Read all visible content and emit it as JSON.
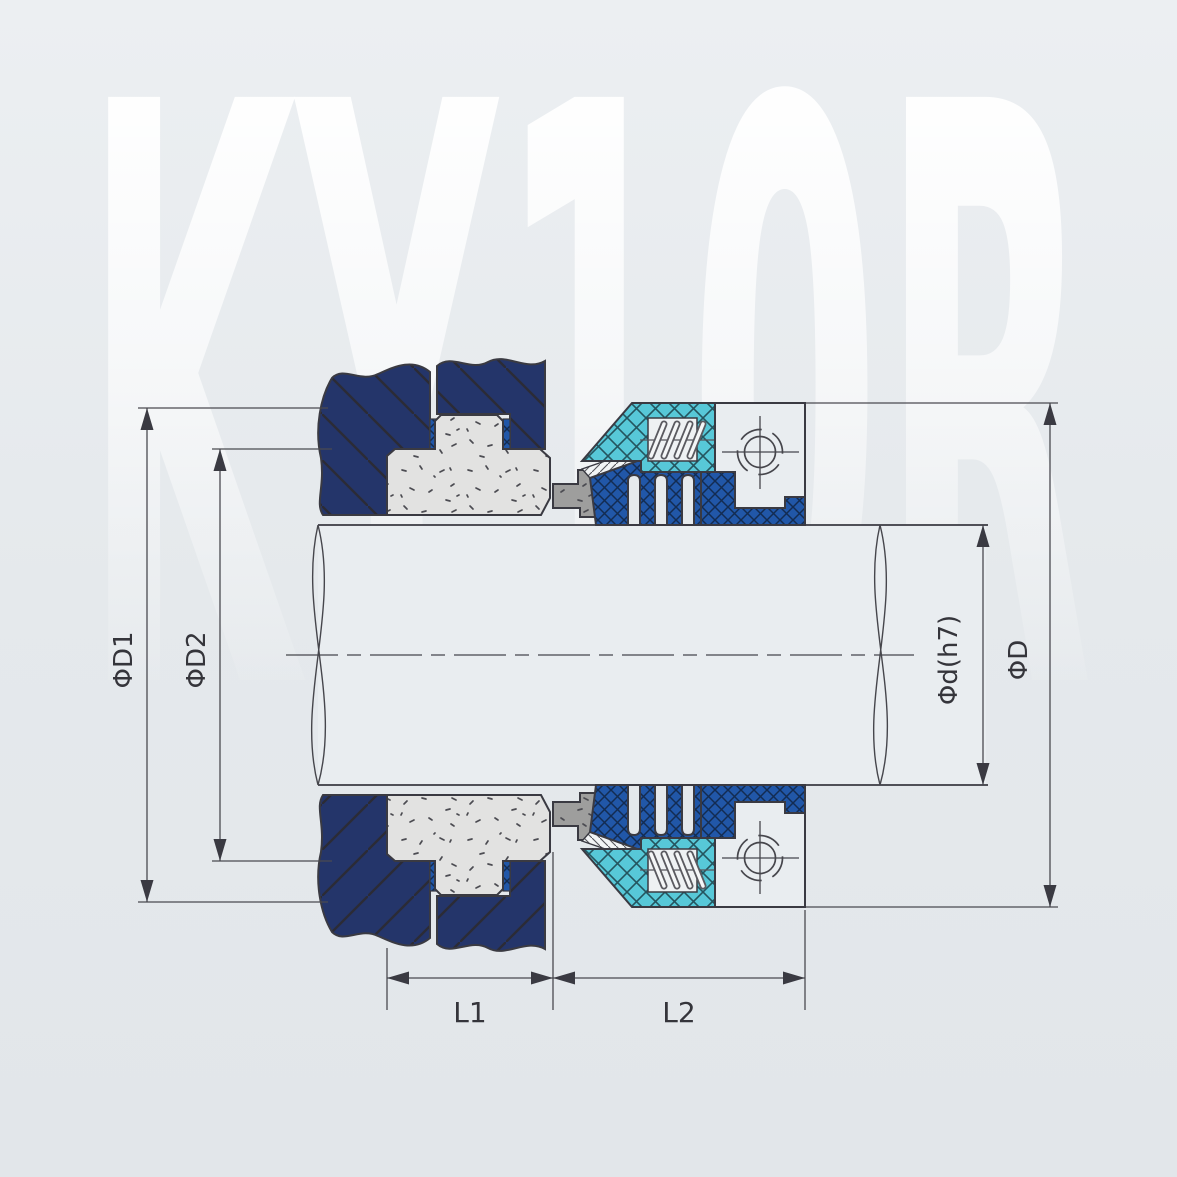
{
  "watermark": {
    "text": "KY10R"
  },
  "dimensions": {
    "phi_d1": {
      "label": "ΦD1"
    },
    "phi_d2": {
      "label": "ΦD2"
    },
    "phi_d_h7": {
      "label": "Φd(h7)"
    },
    "phi_d": {
      "label": "ΦD"
    },
    "l1": {
      "label": "L1"
    },
    "l2": {
      "label": "L2"
    }
  },
  "colors": {
    "background": "#e5e9ec",
    "navy_elastomer": "#24356a",
    "blue_bellows": "#2157a8",
    "cyan_retainer": "#57c8d8",
    "seat_gray": "#e2e2e1",
    "face_gray": "#9e9e9d",
    "white_part": "#e9edf0",
    "outline": "#3a3a42",
    "dimension_line": "#4a4a50",
    "watermark_white": "#ffffff"
  }
}
